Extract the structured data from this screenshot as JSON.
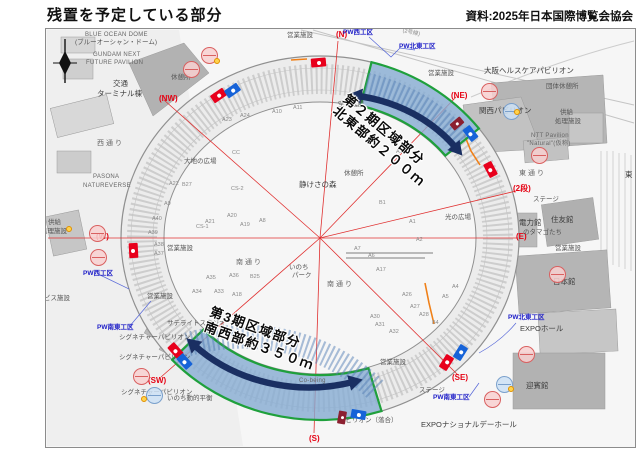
{
  "header": {
    "title": "残置を予定している部分",
    "source": "資料:2025年日本国際博覧会協会"
  },
  "annotations": {
    "phase2_line1": "第２期区域部分",
    "phase2_line2": "北東部約２００ｍ",
    "phase3_line1": "第3期区域部分",
    "phase3_line2": "南西部約３５０ｍ"
  },
  "colors": {
    "highlight_fill": "#85acd4",
    "highlight_stroke": "#1fa03c",
    "arrow_navy": "#1a2f62",
    "compass_red": "#e50012",
    "workzone_blue": "#2020c8",
    "gate_red": "#e8001c",
    "gate_blue": "#1663d8"
  },
  "map": {
    "labels": [
      {
        "t": "(N)",
        "x": 335,
        "y": 30,
        "k": "red",
        "n": "compass-label-n"
      },
      {
        "t": "(NW)",
        "x": 158,
        "y": 94,
        "k": "red",
        "n": "compass-label-nw"
      },
      {
        "t": "(NE)",
        "x": 450,
        "y": 91,
        "k": "red",
        "n": "compass-label-ne"
      },
      {
        "t": "(W)",
        "x": 95,
        "y": 232,
        "k": "red",
        "n": "compass-label-w"
      },
      {
        "t": "(E)",
        "x": 515,
        "y": 232,
        "k": "red",
        "n": "compass-label-e"
      },
      {
        "t": "(2段)",
        "x": 512,
        "y": 184,
        "k": "red",
        "n": "level2-label"
      },
      {
        "t": "(SW)",
        "x": 147,
        "y": 376,
        "k": "red",
        "n": "compass-label-sw"
      },
      {
        "t": "(SE)",
        "x": 451,
        "y": 373,
        "k": "red",
        "n": "compass-label-se"
      },
      {
        "t": "(S)",
        "x": 308,
        "y": 434,
        "k": "red",
        "n": "compass-label-s"
      },
      {
        "t": "PW西工区",
        "x": 342,
        "y": 29,
        "k": "pw",
        "n": "workzone-label"
      },
      {
        "t": "PW北東工区",
        "x": 398,
        "y": 43,
        "k": "pw",
        "n": "workzone-label"
      },
      {
        "t": "PW西工区",
        "x": 82,
        "y": 270,
        "k": "pw",
        "n": "workzone-label"
      },
      {
        "t": "PW南東工区",
        "x": 96,
        "y": 324,
        "k": "pw",
        "n": "workzone-label"
      },
      {
        "t": "PW北東工区",
        "x": 507,
        "y": 314,
        "k": "pw",
        "n": "workzone-label"
      },
      {
        "t": "PW南東工区",
        "x": 432,
        "y": 394,
        "k": "pw",
        "n": "workzone-label"
      },
      {
        "t": "BLUE OCEAN DOME",
        "x": 84,
        "y": 31,
        "k": "en"
      },
      {
        "t": "(ブルーオーシャン・ドーム)",
        "x": 74,
        "y": 39,
        "k": "fac6"
      },
      {
        "t": "GUNDAM NEXT",
        "x": 92,
        "y": 51,
        "k": "en"
      },
      {
        "t": "FUTURE PAVILION",
        "x": 85,
        "y": 59,
        "k": "en"
      },
      {
        "t": "交通",
        "x": 112,
        "y": 79,
        "k": "fac"
      },
      {
        "t": "ターミナル棟",
        "x": 96,
        "y": 89,
        "k": "fac"
      },
      {
        "t": "西通り",
        "x": 96,
        "y": 139,
        "k": "road"
      },
      {
        "t": "PASONA",
        "x": 92,
        "y": 173,
        "k": "en"
      },
      {
        "t": "NATUREVERSE",
        "x": 82,
        "y": 182,
        "k": "en"
      },
      {
        "t": "大地の広場",
        "x": 183,
        "y": 158,
        "k": "fac6"
      },
      {
        "t": "供給",
        "x": 47,
        "y": 219,
        "k": "fac6"
      },
      {
        "t": "処理施設",
        "x": 40,
        "y": 228,
        "k": "fac6"
      },
      {
        "t": "サービス施設",
        "x": 30,
        "y": 295,
        "k": "fac6"
      },
      {
        "t": "休憩所",
        "x": 170,
        "y": 74,
        "k": "fac6"
      },
      {
        "t": "休憩所",
        "x": 343,
        "y": 170,
        "k": "fac6"
      },
      {
        "t": "営業施設",
        "x": 286,
        "y": 32,
        "k": "fac6"
      },
      {
        "t": "営業施設",
        "x": 427,
        "y": 70,
        "k": "fac6"
      },
      {
        "t": "営業施設",
        "x": 166,
        "y": 245,
        "k": "fac6"
      },
      {
        "t": "営業施設",
        "x": 146,
        "y": 293,
        "k": "fac6"
      },
      {
        "t": "営業施設",
        "x": 379,
        "y": 359,
        "k": "fac6"
      },
      {
        "t": "営業施設",
        "x": 554,
        "y": 245,
        "k": "fac6"
      },
      {
        "t": "大阪ヘルスケアパビリオン",
        "x": 483,
        "y": 66,
        "k": "fac"
      },
      {
        "t": "団体休憩所",
        "x": 545,
        "y": 83,
        "k": "fac6"
      },
      {
        "t": "関西パビリオン",
        "x": 478,
        "y": 106,
        "k": "fac"
      },
      {
        "t": "供給",
        "x": 559,
        "y": 109,
        "k": "fac6"
      },
      {
        "t": "処理施設",
        "x": 554,
        "y": 118,
        "k": "fac6"
      },
      {
        "t": "NTT Pavilion",
        "x": 530,
        "y": 132,
        "k": "en"
      },
      {
        "t": "\"Natural\"(仮称)",
        "x": 526,
        "y": 140,
        "k": "en"
      },
      {
        "t": "東通り",
        "x": 518,
        "y": 169,
        "k": "road"
      },
      {
        "t": "ステージ",
        "x": 532,
        "y": 196,
        "k": "fac6"
      },
      {
        "t": "住友館",
        "x": 550,
        "y": 215,
        "k": "fac"
      },
      {
        "t": "電力館",
        "x": 518,
        "y": 218,
        "k": "fac"
      },
      {
        "t": "のタマゴたち",
        "x": 522,
        "y": 229,
        "k": "fac6"
      },
      {
        "t": "日本館",
        "x": 552,
        "y": 277,
        "k": "fac"
      },
      {
        "t": "EXPOホール",
        "x": 519,
        "y": 324,
        "k": "fac"
      },
      {
        "t": "迎賓館",
        "x": 525,
        "y": 381,
        "k": "fac"
      },
      {
        "t": "EXPOナショナルデーホール",
        "x": 420,
        "y": 420,
        "k": "fac"
      },
      {
        "t": "静けさの森",
        "x": 298,
        "y": 180,
        "k": "fac"
      },
      {
        "t": "いのち",
        "x": 288,
        "y": 264,
        "k": "fac6"
      },
      {
        "t": "パーク",
        "x": 291,
        "y": 272,
        "k": "fac6"
      },
      {
        "t": "南通り",
        "x": 235,
        "y": 258,
        "k": "road"
      },
      {
        "t": "南通り",
        "x": 326,
        "y": 280,
        "k": "road"
      },
      {
        "t": "光の広場",
        "x": 444,
        "y": 214,
        "k": "fac6"
      },
      {
        "t": "東",
        "x": 624,
        "y": 170,
        "k": "fac"
      },
      {
        "t": "(2号線)",
        "x": 402,
        "y": 28,
        "k": "blk",
        "r": 12
      },
      {
        "t": "空の広場",
        "x": 337,
        "y": 101,
        "k": "fac6"
      },
      {
        "t": "サテライトスタジオ",
        "x": 166,
        "y": 320,
        "k": "fac6"
      },
      {
        "t": "シグネチャーパビリオン",
        "x": 118,
        "y": 334,
        "k": "fac6"
      },
      {
        "t": "シグネチャーパビリオン",
        "x": 118,
        "y": 354,
        "k": "fac6"
      },
      {
        "t": "シグネチャーパビリオン",
        "x": 120,
        "y": 389,
        "k": "fac6"
      },
      {
        "t": "いのち動的平衡",
        "x": 166,
        "y": 395,
        "k": "fac6"
      },
      {
        "t": "Co-being",
        "x": 298,
        "y": 377,
        "k": "en"
      },
      {
        "t": "ステージ",
        "x": 418,
        "y": 387,
        "k": "fac6"
      },
      {
        "t": "パビリオン（落合）",
        "x": 338,
        "y": 417,
        "k": "fac6"
      },
      {
        "t": "A23",
        "x": 221,
        "y": 117,
        "k": "blk"
      },
      {
        "t": "A24",
        "x": 239,
        "y": 113,
        "k": "blk"
      },
      {
        "t": "A10",
        "x": 271,
        "y": 109,
        "k": "blk"
      },
      {
        "t": "A11",
        "x": 292,
        "y": 105,
        "k": "blk"
      },
      {
        "t": "A15",
        "x": 395,
        "y": 149,
        "k": "blk"
      },
      {
        "t": "A22",
        "x": 168,
        "y": 181,
        "k": "blk"
      },
      {
        "t": "B27",
        "x": 181,
        "y": 182,
        "k": "blk"
      },
      {
        "t": "A9",
        "x": 163,
        "y": 201,
        "k": "blk"
      },
      {
        "t": "A40",
        "x": 151,
        "y": 216,
        "k": "blk"
      },
      {
        "t": "A39",
        "x": 147,
        "y": 230,
        "k": "blk"
      },
      {
        "t": "A38",
        "x": 153,
        "y": 242,
        "k": "blk"
      },
      {
        "t": "A37",
        "x": 153,
        "y": 251,
        "k": "blk"
      },
      {
        "t": "CC",
        "x": 231,
        "y": 150,
        "k": "blk"
      },
      {
        "t": "CS-2",
        "x": 230,
        "y": 186,
        "k": "blk"
      },
      {
        "t": "CS-1",
        "x": 195,
        "y": 224,
        "k": "blk"
      },
      {
        "t": "A21",
        "x": 204,
        "y": 219,
        "k": "blk"
      },
      {
        "t": "A20",
        "x": 226,
        "y": 213,
        "k": "blk"
      },
      {
        "t": "A19",
        "x": 239,
        "y": 222,
        "k": "blk"
      },
      {
        "t": "A8",
        "x": 258,
        "y": 218,
        "k": "blk"
      },
      {
        "t": "A35",
        "x": 205,
        "y": 275,
        "k": "blk"
      },
      {
        "t": "A36",
        "x": 228,
        "y": 273,
        "k": "blk"
      },
      {
        "t": "B25",
        "x": 249,
        "y": 274,
        "k": "blk"
      },
      {
        "t": "B1",
        "x": 378,
        "y": 200,
        "k": "blk"
      },
      {
        "t": "A1",
        "x": 408,
        "y": 219,
        "k": "blk"
      },
      {
        "t": "A2",
        "x": 415,
        "y": 237,
        "k": "blk"
      },
      {
        "t": "A7",
        "x": 353,
        "y": 246,
        "k": "blk"
      },
      {
        "t": "A6",
        "x": 367,
        "y": 253,
        "k": "blk"
      },
      {
        "t": "A17",
        "x": 375,
        "y": 267,
        "k": "blk"
      },
      {
        "t": "A26",
        "x": 401,
        "y": 292,
        "k": "blk"
      },
      {
        "t": "A27",
        "x": 409,
        "y": 304,
        "k": "blk"
      },
      {
        "t": "A28",
        "x": 418,
        "y": 312,
        "k": "blk"
      },
      {
        "t": "A30",
        "x": 369,
        "y": 314,
        "k": "blk"
      },
      {
        "t": "A31",
        "x": 374,
        "y": 322,
        "k": "blk"
      },
      {
        "t": "A32",
        "x": 388,
        "y": 329,
        "k": "blk"
      },
      {
        "t": "A4",
        "x": 451,
        "y": 284,
        "k": "blk"
      },
      {
        "t": "A5",
        "x": 441,
        "y": 294,
        "k": "blk"
      },
      {
        "t": "B4",
        "x": 431,
        "y": 320,
        "k": "blk"
      },
      {
        "t": "A34",
        "x": 191,
        "y": 289,
        "k": "blk"
      },
      {
        "t": "A33",
        "x": 213,
        "y": 289,
        "k": "blk"
      },
      {
        "t": "A18",
        "x": 231,
        "y": 292,
        "k": "blk"
      }
    ],
    "badges": [
      {
        "x": 200,
        "y": 46
      },
      {
        "x": 182,
        "y": 60
      },
      {
        "x": 88,
        "y": 224
      },
      {
        "x": 89,
        "y": 248
      },
      {
        "x": 480,
        "y": 82
      },
      {
        "x": 530,
        "y": 146
      },
      {
        "x": 548,
        "y": 265
      },
      {
        "x": 132,
        "y": 367
      },
      {
        "x": 517,
        "y": 345
      },
      {
        "x": 483,
        "y": 390
      },
      {
        "x": 502,
        "y": 102,
        "c": "blue"
      },
      {
        "x": 145,
        "y": 386,
        "c": "blue"
      },
      {
        "x": 495,
        "y": 375,
        "c": "blue"
      }
    ],
    "ydots": [
      {
        "x": 213,
        "y": 57
      },
      {
        "x": 65,
        "y": 225
      },
      {
        "x": 513,
        "y": 108
      },
      {
        "x": 140,
        "y": 395
      },
      {
        "x": 507,
        "y": 385
      }
    ],
    "gates": [
      {
        "x": 210,
        "y": 90,
        "r": -35,
        "c": "red"
      },
      {
        "x": 224,
        "y": 85,
        "r": -35,
        "c": "blue"
      },
      {
        "x": 310,
        "y": 57,
        "r": -5,
        "c": "red"
      },
      {
        "x": 482,
        "y": 164,
        "r": 62,
        "c": "red"
      },
      {
        "x": 125,
        "y": 245,
        "r": 87,
        "c": "red"
      },
      {
        "x": 167,
        "y": 345,
        "r": 48,
        "c": "red"
      },
      {
        "x": 176,
        "y": 356,
        "r": 48,
        "c": "blue"
      },
      {
        "x": 438,
        "y": 357,
        "r": -58,
        "c": "red"
      },
      {
        "x": 452,
        "y": 347,
        "r": -58,
        "c": "blue"
      },
      {
        "x": 452,
        "y": 116,
        "r": 50,
        "c": "maroon"
      },
      {
        "x": 462,
        "y": 128,
        "r": 52,
        "c": "blue"
      },
      {
        "x": 337,
        "y": 410,
        "r": 10,
        "c": "maroon"
      },
      {
        "x": 350,
        "y": 409,
        "r": 10,
        "c": "blue"
      }
    ]
  }
}
